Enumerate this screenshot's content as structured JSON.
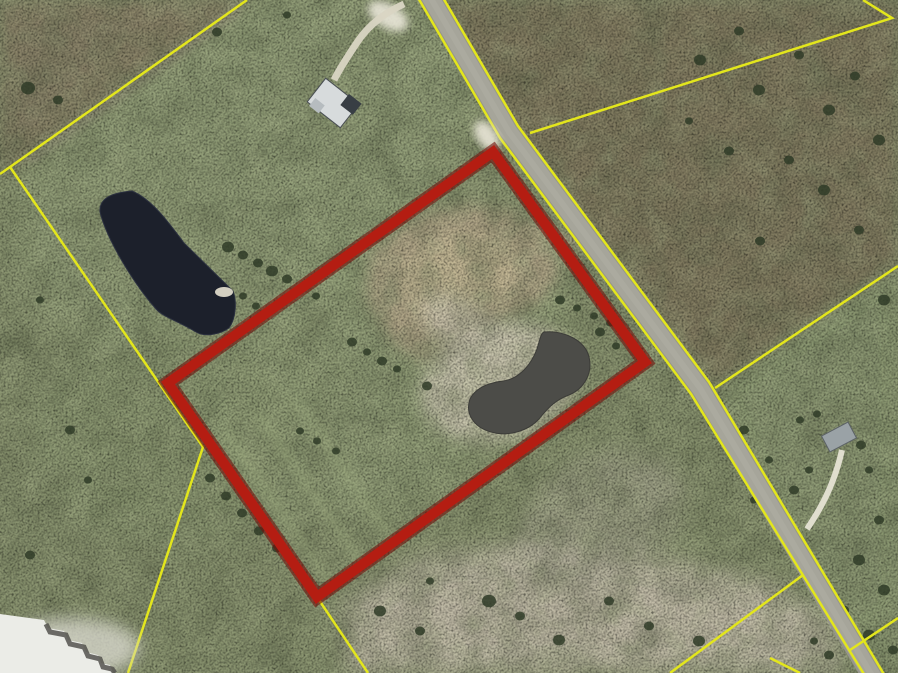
{
  "map": {
    "type": "aerial-parcel-map",
    "viewBox": "0 0 898 673",
    "colors": {
      "highlight_outline": "#b41d12",
      "highlight_outline_dark": "#70100a",
      "parcel_boundary_yellow": "#e3e61c",
      "road_gray": "#a6a59a",
      "pond_dark": "#1c202b",
      "pond_inner": "#4c4c48",
      "pasture_green": "#8a9470",
      "scrub_brown": "#837a61",
      "sand_light": "#c3bda9",
      "dirt_tan": "#b2a688",
      "building_white": "#ebece7"
    },
    "layers": [
      {
        "tag": "rect",
        "name": "base-terrain",
        "attrs": {
          "x": 0,
          "y": 0,
          "width": 898,
          "height": 673,
          "fill": "#8a9470"
        }
      },
      {
        "tag": "ellipse",
        "name": "pasture-upper-left",
        "attrs": {
          "cx": 250,
          "cy": 160,
          "rx": 260,
          "ry": 160,
          "transform": "rotate(-30 250 160)",
          "fill": "#96a37c",
          "opacity": 0.7,
          "filter": "url(#b12)"
        }
      },
      {
        "tag": "ellipse",
        "name": "pasture-mid-left",
        "attrs": {
          "cx": 180,
          "cy": 430,
          "rx": 150,
          "ry": 120,
          "fill": "#8d9a73",
          "opacity": 0.6,
          "filter": "url(#b12)"
        }
      },
      {
        "tag": "polygon",
        "name": "scrub-top-left",
        "attrs": {
          "points": "0,0 250,0 10,168 0,175",
          "fill": "#8b8168",
          "opacity": 0.85,
          "filter": "url(#b8)"
        }
      },
      {
        "tag": "polygon",
        "name": "scrub-right-of-road",
        "attrs": {
          "points": "437,0 898,0 898,266 715,388 505,115",
          "fill": "#837a61",
          "opacity": 0.9,
          "filter": "url(#b8)"
        }
      },
      {
        "tag": "polygon",
        "name": "pasture-right-lower",
        "attrs": {
          "points": "715,388 898,266 898,612 851,649 803,575",
          "fill": "#8e9b74",
          "opacity": 0.85,
          "filter": "url(#b8)"
        }
      },
      {
        "tag": "polygon",
        "name": "green-bottom-right",
        "attrs": {
          "points": "803,575 851,649 898,618 898,673 688,673",
          "fill": "#828f6a",
          "opacity": 0.85,
          "filter": "url(#b8)"
        }
      },
      {
        "tag": "ellipse",
        "name": "parcel-interior-pasture",
        "attrs": {
          "cx": 390,
          "cy": 360,
          "rx": 200,
          "ry": 150,
          "transform": "rotate(-35 390 360)",
          "fill": "#99a67e",
          "opacity": 0.5,
          "filter": "url(#b12)"
        }
      },
      {
        "tag": "polygon",
        "name": "sand-area-bottom",
        "attrs": {
          "points": "345,602 420,558 540,542 660,560 780,586 836,626 842,673 348,673",
          "fill": "#c3bda9",
          "opacity": 0.95,
          "filter": "url(#b12)"
        }
      },
      {
        "tag": "ellipse",
        "name": "sand-area-mid",
        "attrs": {
          "cx": 600,
          "cy": 520,
          "rx": 90,
          "ry": 60,
          "transform": "rotate(-30 600 520)",
          "fill": "#aaa794",
          "opacity": 0.55,
          "filter": "url(#b12)"
        }
      },
      {
        "tag": "polygon",
        "name": "dirt-patch",
        "attrs": {
          "points": "372,252 418,214 470,204 522,214 548,242 560,272 538,302 498,322 468,346 428,362 393,342 368,300",
          "fill": "#b2a688",
          "opacity": 0.95,
          "filter": "url(#b8)"
        }
      },
      {
        "tag": "polygon",
        "name": "dirt-patch-core",
        "attrs": {
          "points": "400,262 450,230 502,236 526,262 510,296 464,316 424,320 400,294",
          "fill": "#c3b795",
          "opacity": 0.9,
          "filter": "url(#b4)"
        }
      },
      {
        "tag": "path",
        "name": "dirt-trail",
        "attrs": {
          "d": "M520,224 L606,250",
          "stroke": "#b6ab8c",
          "stroke-width": 8,
          "fill": "none",
          "opacity": 0.75,
          "filter": "url(#b4)"
        }
      },
      {
        "tag": "ellipse",
        "name": "pond-beach",
        "attrs": {
          "cx": 500,
          "cy": 382,
          "rx": 80,
          "ry": 58,
          "transform": "rotate(-18 500 382)",
          "fill": "#d0cab5",
          "opacity": 0.85,
          "filter": "url(#b8)"
        }
      },
      {
        "tag": "ellipse",
        "name": "pond-beach-arm",
        "attrs": {
          "cx": 466,
          "cy": 332,
          "rx": 52,
          "ry": 26,
          "transform": "rotate(38 466 332)",
          "fill": "#cdc7b2",
          "opacity": 0.7,
          "filter": "url(#b8)"
        }
      },
      {
        "tag": "path",
        "name": "dirt-track-boundary",
        "attrs": {
          "d": "M238,8 L30,160",
          "stroke": "#98927f",
          "stroke-width": 9,
          "fill": "none",
          "opacity": 0.55,
          "filter": "url(#b4)"
        }
      },
      {
        "tag": "rect",
        "name": "terrain-mottle-dark",
        "attrs": {
          "x": 0,
          "y": 0,
          "width": 898,
          "height": 673,
          "filter": "url(#mottleDark)",
          "opacity": 0.5
        }
      },
      {
        "tag": "rect",
        "name": "terrain-mottle-light",
        "attrs": {
          "x": 0,
          "y": 0,
          "width": 898,
          "height": 673,
          "filter": "url(#mottleLight)",
          "opacity": 0.4
        }
      },
      {
        "tag": "rect",
        "name": "terrain-speckle",
        "attrs": {
          "x": 0,
          "y": 0,
          "width": 898,
          "height": 673,
          "filter": "url(#speck)",
          "opacity": 0.45
        }
      },
      {
        "tag": "path",
        "name": "mow-stripe",
        "attrs": {
          "d": "M225,432 L330,583",
          "stroke": "#a3b183",
          "stroke-width": 10,
          "fill": "none",
          "opacity": 0.3,
          "filter": "url(#b4)"
        }
      },
      {
        "tag": "path",
        "name": "mow-stripe",
        "attrs": {
          "d": "M258,414 L363,565",
          "stroke": "#a3b183",
          "stroke-width": 10,
          "fill": "none",
          "opacity": 0.3,
          "filter": "url(#b4)"
        }
      },
      {
        "tag": "path",
        "name": "mow-stripe",
        "attrs": {
          "d": "M292,396 L397,547",
          "stroke": "#a3b183",
          "stroke-width": 10,
          "fill": "none",
          "opacity": 0.3,
          "filter": "url(#b4)"
        }
      },
      {
        "tag": "path",
        "name": "pond-left",
        "attrs": {
          "d": "M100,212 C99,199 110,193 132,191 C151,199 167,220 184,243 L233,291 C237,301 236,319 229,328 C219,335 204,337 196,332 C178,321 163,317 156,309 C134,284 107,240 100,212 Z",
          "fill": "#1c202b",
          "stroke": "#2c3140",
          "stroke-width": 1
        }
      },
      {
        "tag": "ellipse",
        "name": "pond-left-beach-spot",
        "attrs": {
          "cx": 224,
          "cy": 292,
          "rx": 9,
          "ry": 5,
          "fill": "#ddd9c9",
          "opacity": 0.95
        }
      },
      {
        "tag": "path",
        "name": "pond-inner-parcel",
        "attrs": {
          "d": "M544,332 C563,330 585,340 589,357 C593,373 584,389 569,395 C555,400 547,409 539,419 C528,431 508,437 491,432 C473,427 465,413 470,399 C475,389 487,383 503,381 C519,379 531,365 537,349 C540,339 541,333 544,332 Z",
          "fill": "#4c4c48",
          "stroke": "#3c3c38",
          "stroke-width": 1
        }
      },
      {
        "tag": "path",
        "name": "road-casing",
        "attrs": {
          "d": "M426,-10 L509,132 L700,388 L876,682",
          "stroke": "#97968b",
          "stroke-width": 21,
          "fill": "none"
        }
      },
      {
        "tag": "path",
        "name": "road-surface",
        "attrs": {
          "d": "M426,-10 L509,132 L700,388 L876,682",
          "stroke": "#a6a59a",
          "stroke-width": 17,
          "fill": "none"
        }
      },
      {
        "tag": "path",
        "name": "road-worn-stripe",
        "attrs": {
          "d": "M426,-10 L509,132 L700,388 L876,682",
          "stroke": "#b0afa3",
          "stroke-width": 6,
          "fill": "none",
          "opacity": 0.5
        }
      },
      {
        "tag": "polyline",
        "name": "road-edge-line-west",
        "attrs": {
          "points": "417,-4 500,138 691,394 867,679",
          "stroke": "#e3e61c",
          "stroke-width": 2.5,
          "fill": "none"
        }
      },
      {
        "tag": "polyline",
        "name": "road-edge-line-east",
        "attrs": {
          "points": "435,-16 518,126 709,382 885,676",
          "stroke": "#e3e61c",
          "stroke-width": 2.5,
          "fill": "none"
        }
      },
      {
        "tag": "polyline",
        "name": "parcel-boundary-line",
        "attrs": {
          "points": "247,0 10,167 0,174",
          "stroke": "#e3e61c",
          "stroke-width": 2.5,
          "fill": "none"
        }
      },
      {
        "tag": "polyline",
        "name": "parcel-boundary-line",
        "attrs": {
          "points": "10,167 203,447 128,673",
          "stroke": "#e3e61c",
          "stroke-width": 2.5,
          "fill": "none"
        }
      },
      {
        "tag": "polyline",
        "name": "parcel-boundary-line",
        "attrs": {
          "points": "530,133 892,18 863,0",
          "stroke": "#e3e61c",
          "stroke-width": 2.5,
          "fill": "none"
        }
      },
      {
        "tag": "polyline",
        "name": "parcel-boundary-line",
        "attrs": {
          "points": "715,388 898,266",
          "stroke": "#e3e61c",
          "stroke-width": 2.5,
          "fill": "none"
        }
      },
      {
        "tag": "polyline",
        "name": "parcel-boundary-line",
        "attrs": {
          "points": "803,575 670,673",
          "stroke": "#e3e61c",
          "stroke-width": 2.5,
          "fill": "none"
        }
      },
      {
        "tag": "polyline",
        "name": "parcel-boundary-line",
        "attrs": {
          "points": "850,650 898,618",
          "stroke": "#e3e61c",
          "stroke-width": 2.5,
          "fill": "none"
        }
      },
      {
        "tag": "polyline",
        "name": "parcel-boundary-line",
        "attrs": {
          "points": "317,597 368,673",
          "stroke": "#e3e61c",
          "stroke-width": 2.5,
          "fill": "none"
        }
      },
      {
        "tag": "polyline",
        "name": "parcel-boundary-line",
        "attrs": {
          "points": "770,658 800,673",
          "stroke": "#e3e61c",
          "stroke-width": 2.5,
          "fill": "none"
        }
      },
      {
        "tag": "ellipse",
        "name": "driveway-pad-north",
        "attrs": {
          "cx": 388,
          "cy": 16,
          "rx": 22,
          "ry": 12,
          "transform": "rotate(30 388 16)",
          "fill": "#e9e6d8",
          "opacity": 0.9,
          "filter": "url(#b4)"
        }
      },
      {
        "tag": "path",
        "name": "driveway-north",
        "attrs": {
          "d": "M404,4 C382,14 366,28 356,44 C348,56 340,68 334,80",
          "stroke": "#d9d5c3",
          "stroke-width": 7,
          "fill": "none",
          "opacity": 0.95
        }
      },
      {
        "tag": "ellipse",
        "name": "driveway-pad-parcel-corner",
        "attrs": {
          "cx": 487,
          "cy": 136,
          "rx": 17,
          "ry": 10,
          "transform": "rotate(55 487 136)",
          "fill": "#e4e1d2",
          "opacity": 0.95,
          "filter": "url(#b4)"
        }
      },
      {
        "tag": "path",
        "name": "driveway-east",
        "attrs": {
          "d": "M842,450 C837,472 829,492 820,508 C815,517 811,523 807,529",
          "stroke": "#e6e3d4",
          "stroke-width": 6,
          "fill": "none",
          "opacity": 0.95
        }
      },
      {
        "tag": "rect",
        "name": "house-north-roof",
        "attrs": {
          "x": 312,
          "y": 88,
          "width": 42,
          "height": 30,
          "transform": "rotate(38 333 103)",
          "fill": "#d7dbdc",
          "stroke": "#4a4f54",
          "stroke-width": 1
        }
      },
      {
        "tag": "rect",
        "name": "house-north-wing",
        "attrs": {
          "x": 340,
          "y": 86,
          "width": 16,
          "height": 14,
          "transform": "rotate(38 333 103)",
          "fill": "#383e44"
        }
      },
      {
        "tag": "rect",
        "name": "house-north-shed",
        "attrs": {
          "x": 316,
          "y": 110,
          "width": 12,
          "height": 10,
          "transform": "rotate(38 333 103)",
          "fill": "#b6bcbf"
        }
      },
      {
        "tag": "rect",
        "name": "house-east-roof",
        "attrs": {
          "x": 824,
          "y": 428,
          "width": 30,
          "height": 18,
          "transform": "rotate(-28 839 437)",
          "fill": "#9aa2a6",
          "stroke": "#5c6266",
          "stroke-width": 1
        }
      },
      {
        "tag": "ellipse",
        "name": "industrial-apron",
        "attrs": {
          "cx": 70,
          "cy": 648,
          "rx": 70,
          "ry": 30,
          "fill": "#d6d6ca",
          "opacity": 0.8,
          "filter": "url(#b8)"
        }
      },
      {
        "tag": "polygon",
        "name": "industrial-building-roof",
        "attrs": {
          "points": "0,614 44,620 48,628 64,631 68,640 82,643 86,652 98,655 101,663 110,665 113,673 0,673",
          "fill": "#ebece7"
        }
      },
      {
        "tag": "polyline",
        "name": "industrial-building-shadow",
        "attrs": {
          "points": "46,624 50,632 66,635 70,644 84,647 88,656 100,659 103,667 112,669 115,673",
          "stroke": "#54524e",
          "stroke-width": 5,
          "fill": "none",
          "opacity": 0.85
        }
      },
      {
        "tag": "polygon",
        "name": "parcel-highlight-outline-shadow",
        "attrs": {
          "points": "493,152 645,362 317,597 168,383",
          "fill": "none",
          "stroke": "#70100a",
          "stroke-width": 15,
          "opacity": 0.6,
          "stroke-linejoin": "miter"
        }
      },
      {
        "tag": "polygon",
        "name": "parcel-highlight-outline",
        "attrs": {
          "points": "493,152 645,362 317,597 168,383",
          "fill": "none",
          "stroke": "#b41d12",
          "stroke-width": 10,
          "stroke-linejoin": "miter"
        }
      }
    ],
    "tree_style": {
      "fill": "#2f3b27",
      "opacity": 0.85
    },
    "trees": [
      [
        228,
        247,
        6
      ],
      [
        243,
        255,
        5
      ],
      [
        258,
        263,
        5
      ],
      [
        272,
        271,
        6
      ],
      [
        287,
        279,
        5
      ],
      [
        302,
        288,
        5
      ],
      [
        316,
        296,
        4
      ],
      [
        243,
        296,
        4
      ],
      [
        256,
        306,
        4
      ],
      [
        352,
        342,
        5
      ],
      [
        367,
        352,
        4
      ],
      [
        382,
        361,
        5
      ],
      [
        397,
        369,
        4
      ],
      [
        427,
        386,
        5
      ],
      [
        300,
        431,
        4
      ],
      [
        317,
        441,
        4
      ],
      [
        336,
        451,
        4
      ],
      [
        560,
        300,
        5
      ],
      [
        577,
        308,
        4
      ],
      [
        594,
        316,
        4
      ],
      [
        610,
        323,
        4
      ],
      [
        600,
        332,
        5
      ],
      [
        616,
        346,
        4
      ],
      [
        210,
        478,
        5
      ],
      [
        226,
        496,
        5
      ],
      [
        242,
        513,
        5
      ],
      [
        259,
        531,
        5
      ],
      [
        277,
        548,
        5
      ],
      [
        294,
        563,
        4
      ],
      [
        380,
        611,
        6
      ],
      [
        420,
        631,
        5
      ],
      [
        489,
        601,
        7
      ],
      [
        520,
        616,
        5
      ],
      [
        559,
        640,
        6
      ],
      [
        609,
        601,
        5
      ],
      [
        649,
        626,
        5
      ],
      [
        699,
        641,
        6
      ],
      [
        430,
        581,
        4
      ],
      [
        700,
        60,
        6
      ],
      [
        739,
        31,
        5
      ],
      [
        759,
        90,
        6
      ],
      [
        799,
        55,
        5
      ],
      [
        829,
        110,
        6
      ],
      [
        855,
        76,
        5
      ],
      [
        879,
        140,
        6
      ],
      [
        789,
        160,
        5
      ],
      [
        824,
        190,
        6
      ],
      [
        859,
        230,
        5
      ],
      [
        884,
        300,
        6
      ],
      [
        760,
        241,
        5
      ],
      [
        729,
        151,
        5
      ],
      [
        689,
        121,
        4
      ],
      [
        744,
        430,
        5
      ],
      [
        769,
        460,
        4
      ],
      [
        794,
        490,
        5
      ],
      [
        754,
        500,
        4
      ],
      [
        879,
        520,
        5
      ],
      [
        859,
        560,
        6
      ],
      [
        884,
        590,
        6
      ],
      [
        844,
        610,
        5
      ],
      [
        869,
        635,
        6
      ],
      [
        829,
        655,
        5
      ],
      [
        893,
        650,
        5
      ],
      [
        814,
        641,
        4
      ],
      [
        800,
        420,
        4
      ],
      [
        817,
        414,
        4
      ],
      [
        861,
        445,
        5
      ],
      [
        869,
        470,
        4
      ],
      [
        809,
        470,
        4
      ],
      [
        28,
        88,
        7
      ],
      [
        58,
        100,
        5
      ],
      [
        40,
        300,
        4
      ],
      [
        70,
        430,
        5
      ],
      [
        30,
        555,
        5
      ],
      [
        88,
        480,
        4
      ],
      [
        217,
        32,
        5
      ],
      [
        287,
        15,
        4
      ]
    ]
  }
}
